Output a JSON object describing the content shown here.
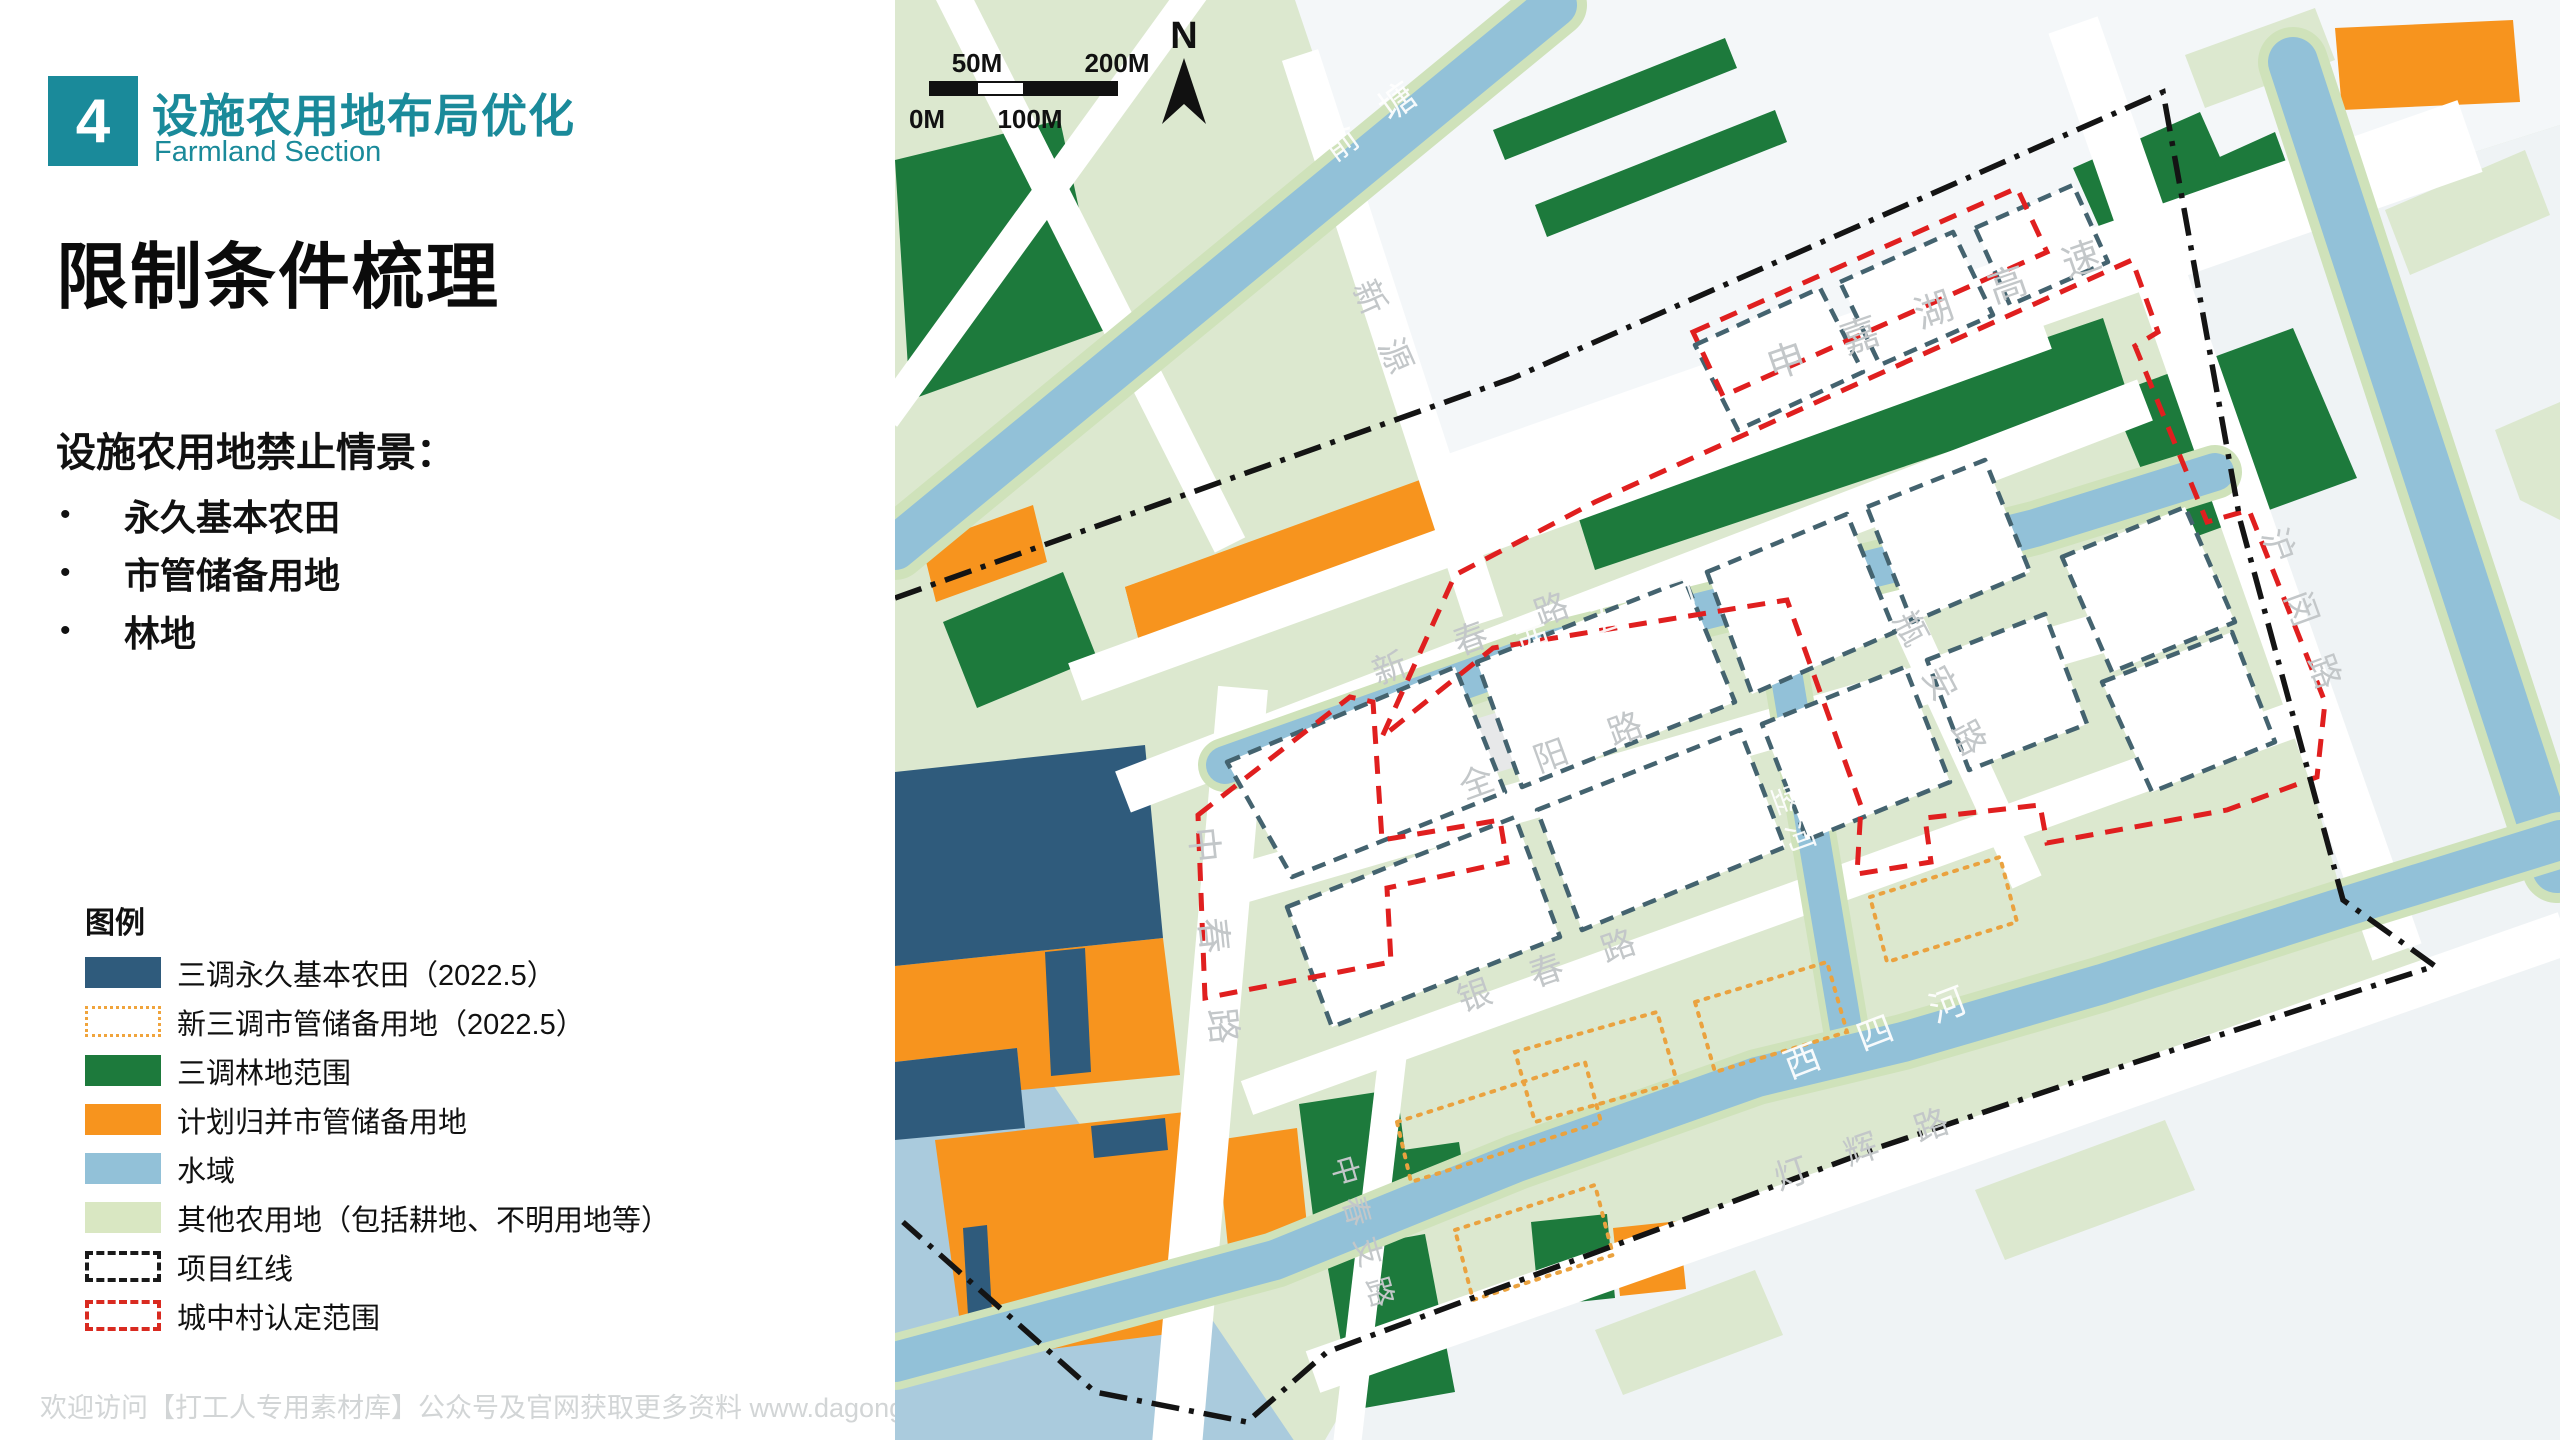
{
  "header": {
    "badge": "4",
    "title": "设施农用地布局优化",
    "subtitle": "Farmland Section"
  },
  "heading": "限制条件梳理",
  "prohibit": {
    "title": "设施农用地禁止情景：",
    "items": [
      "永久基本农田",
      "市管储备用地",
      "林地"
    ]
  },
  "legend": {
    "title": "图例",
    "items": [
      {
        "label": "三调永久基本农田（2022.5）",
        "style": "fill",
        "color": "#2F5B7C"
      },
      {
        "label": "新三调市管储备用地（2022.5）",
        "style": "dotted-outline",
        "color": "#F0A43C"
      },
      {
        "label": "三调林地范围",
        "style": "fill",
        "color": "#1D7A3C"
      },
      {
        "label": "计划归并市管储备用地",
        "style": "fill",
        "color": "#F7941E"
      },
      {
        "label": "水域",
        "style": "fill",
        "color": "#92C1D8"
      },
      {
        "label": "其他农用地（包括耕地、不明用地等）",
        "style": "fill",
        "color": "#D9E7C2"
      },
      {
        "label": "项目红线",
        "style": "dashed-outline",
        "color": "#1A1A1A"
      },
      {
        "label": "城中村认定范围",
        "style": "dashed-outline",
        "color": "#D92A20"
      }
    ]
  },
  "footer": "欢迎访问【打工人专用素材库】公众号及官网获取更多资料 www.dagongrensucai.com",
  "map": {
    "north": "N",
    "scalebar": {
      "top_left": "50M",
      "top_right": "200M",
      "bottom_left": "0M",
      "bottom_center": "100M"
    },
    "labels": [
      {
        "text": "俞塘",
        "kind": "river"
      },
      {
        "text": "新源",
        "kind": "road"
      },
      {
        "text": "申嘉湖高速",
        "kind": "road"
      },
      {
        "text": "沪闵路",
        "kind": "road"
      },
      {
        "text": "新春路",
        "kind": "road"
      },
      {
        "text": "西五河",
        "kind": "river"
      },
      {
        "text": "全阳路",
        "kind": "road"
      },
      {
        "text": "瓶安路",
        "kind": "road"
      },
      {
        "text": "竖河",
        "kind": "river"
      },
      {
        "text": "中春路",
        "kind": "road"
      },
      {
        "text": "银春路",
        "kind": "road"
      },
      {
        "text": "西四河",
        "kind": "river"
      },
      {
        "text": "中春支路",
        "kind": "road"
      },
      {
        "text": "灯辉路",
        "kind": "road"
      }
    ],
    "colors": {
      "base_farmland": "#DCE8CF",
      "urban_pale": "#F2F5F7",
      "water": "#92C1D8",
      "water_edge": "#CFE2BA",
      "forest": "#1D7A3C",
      "reserve_orange": "#F7941E",
      "basic_farmland_blue": "#2F5B7C",
      "parcel_stroke": "#44636F",
      "red_line": "#E01F1F",
      "project_line": "#141414"
    }
  }
}
